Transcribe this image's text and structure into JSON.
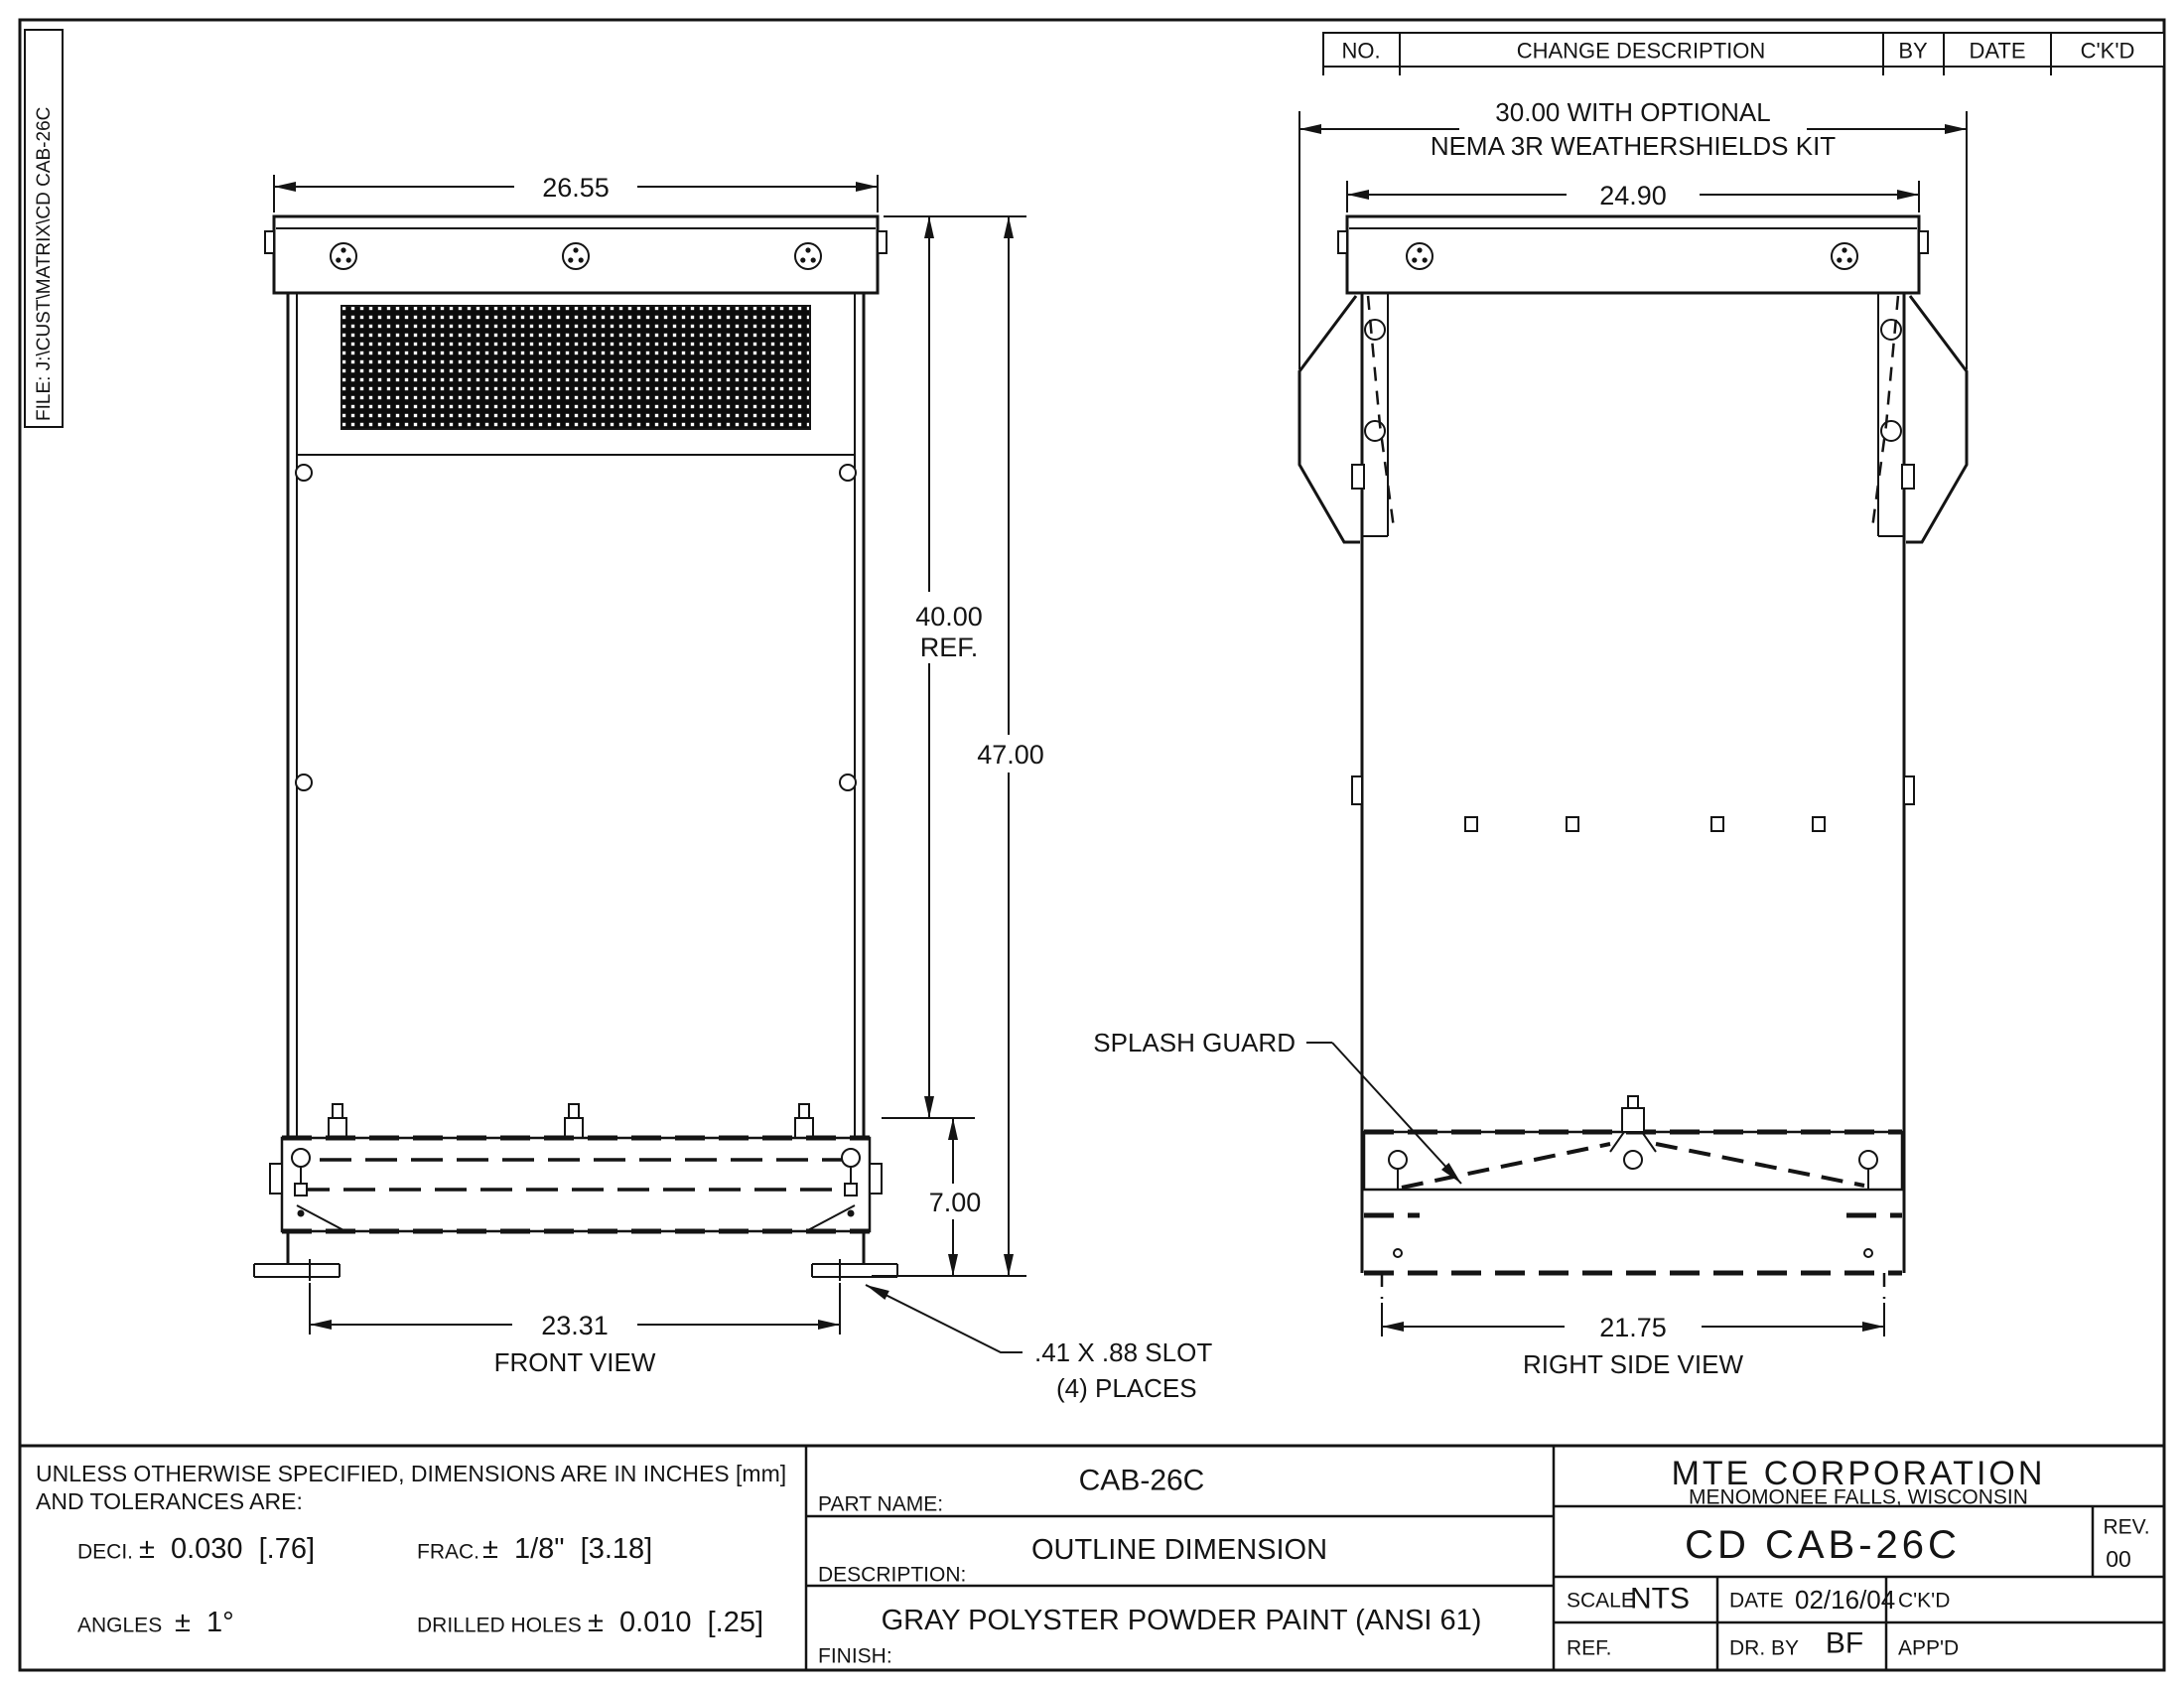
{
  "file_label": "FILE: J:\\CUST\\MATRIX\\CD CAB-26C",
  "change_table": {
    "no_label": "NO.",
    "description_label": "CHANGE DESCRIPTION",
    "by_label": "BY",
    "date_label": "DATE",
    "ckd_label": "C'K'D"
  },
  "front_view": {
    "title": "FRONT VIEW",
    "dim_width_top": "26.55",
    "dim_height_ref": "40.00",
    "dim_height_ref_suffix": "REF.",
    "dim_height_total": "47.00",
    "dim_splash_height": "7.00",
    "dim_slot_span": "23.31",
    "slot_note_line1": ".41 X .88 SLOT",
    "slot_note_line2": "(4) PLACES"
  },
  "side_view": {
    "title": "RIGHT SIDE VIEW",
    "note_line1": "30.00 WITH OPTIONAL",
    "note_line2": "NEMA 3R WEATHERSHIELDS KIT",
    "dim_width_top": "24.90",
    "dim_slot_span": "21.75",
    "splash_guard_label": "SPLASH GUARD"
  },
  "title_block": {
    "tolerance_line1": "UNLESS OTHERWISE SPECIFIED, DIMENSIONS ARE IN INCHES [mm]",
    "tolerance_line2": "AND TOLERANCES ARE:",
    "deci_label": "DECI.",
    "deci_value": "± 0.030 [.76]",
    "frac_label": "FRAC.",
    "frac_value": "± 1/8\" [3.18]",
    "angles_label": "ANGLES",
    "angles_value": "± 1°",
    "drilled_holes_label": "DRILLED HOLES",
    "drilled_holes_value": "± 0.010 [.25]",
    "part_name_label": "PART NAME:",
    "part_name": "CAB-26C",
    "description_label": "DESCRIPTION:",
    "description": "OUTLINE DIMENSION",
    "finish_label": "FINISH:",
    "finish": "GRAY POLYSTER POWDER PAINT (ANSI 61)",
    "company_name": "MTE CORPORATION",
    "company_location": "MENOMONEE FALLS, WISCONSIN",
    "drawing_number": "CD CAB-26C",
    "rev_label": "REV.",
    "rev_value": "00",
    "scale_label": "SCALE",
    "scale_value": "NTS",
    "date_label": "DATE",
    "date_value": "02/16/04",
    "ckd_label": "C'K'D",
    "ref_label": "REF.",
    "drawn_by_label": "DR. BY",
    "drawn_by_value": "BF",
    "approved_label": "APP'D"
  }
}
